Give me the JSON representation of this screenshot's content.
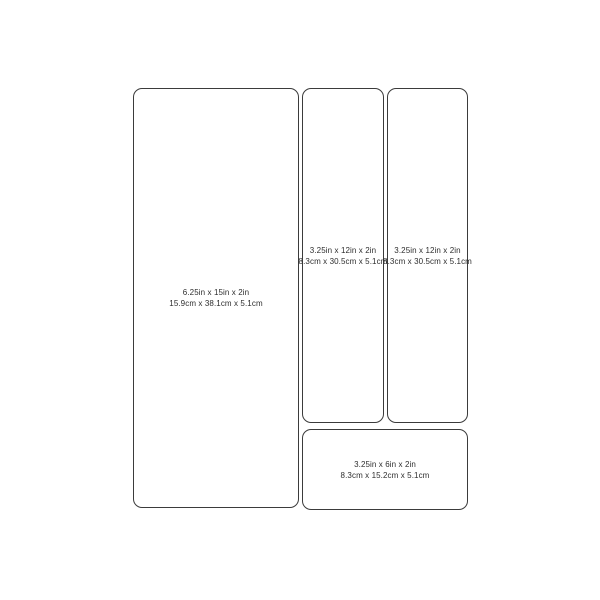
{
  "diagram": {
    "background_color": "#ffffff",
    "outline_color": "#3b3b3b",
    "text_color": "#2e2e2e",
    "panels": [
      {
        "name": "tray-large",
        "line1": "6.25in x 15in x 2in",
        "line2": "15.9cm x 38.1cm x 5.1cm"
      },
      {
        "name": "tray-tall-1",
        "line1": "3.25in x 12in x 2in",
        "line2": "8.3cm x 30.5cm x 5.1cm"
      },
      {
        "name": "tray-tall-2",
        "line1": "3.25in x 12in x 2in",
        "line2": "8.3cm x 30.5cm x 5.1cm"
      },
      {
        "name": "tray-small",
        "line1": "3.25in x 6in x 2in",
        "line2": "8.3cm x 15.2cm x 5.1cm"
      }
    ]
  }
}
